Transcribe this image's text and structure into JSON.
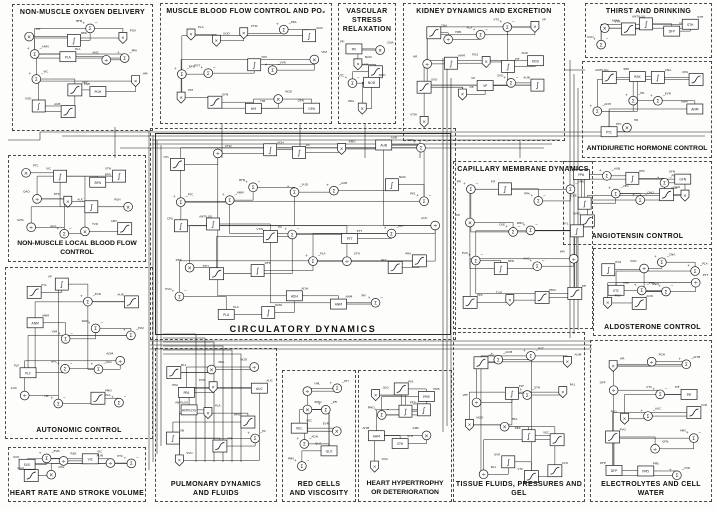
{
  "diagram": {
    "kind": "physiological-systems-block-diagram",
    "colors": {
      "ink": "#1c1c1c",
      "paper": "#fdfdfb",
      "section_border": "#4a4a4a"
    },
    "symbols": {
      "sum": "Σ",
      "multiply": "×",
      "divide": "÷",
      "plus": "+",
      "minus": "−",
      "integral": "∫"
    },
    "micro_labels": [
      "PO2",
      "STH",
      "POT",
      "POV",
      "AOM",
      "BFN",
      "PMO",
      "RMO",
      "EVR",
      "PVO",
      "OVA",
      "PK1",
      "PM5",
      "AUC",
      "AUB",
      "AUN",
      "PA1",
      "PLA",
      "PPA",
      "PRA",
      "QLO",
      "QAO",
      "VVR",
      "PTT",
      "HYL",
      "PTC",
      "PIF",
      "VTS",
      "AMC",
      "AMK",
      "CNA",
      "CKE",
      "ADH",
      "AHM",
      "VUD",
      "TVD",
      "GFN",
      "VTW",
      "HM",
      "VIM",
      "VP",
      "VB",
      "HPL",
      "HPR",
      "HR",
      "SVO",
      "PPC",
      "PFI",
      "DFP",
      "VPF",
      "PLF",
      "PGH",
      "CPG",
      "PC",
      "KOD",
      "NOD",
      "VEC",
      "VIC",
      "VTC",
      "ANM",
      "REK",
      "ANTILOG"
    ],
    "sections": [
      {
        "id": "non-muscle-oxygen-delivery",
        "title": "NON-MUSCLE  OXYGEN  DELIVERY",
        "box": [
          12,
          4,
          141,
          127
        ],
        "title_pos": "top",
        "n": 14
      },
      {
        "id": "muscle-blood-flow-control",
        "title": "MUSCLE BLOOD FLOW CONTROL AND PO₂",
        "box": [
          160,
          3,
          172,
          121
        ],
        "title_pos": "top",
        "n": 15
      },
      {
        "id": "vascular-stress-relaxation",
        "title": "VASCULAR\nSTRESS\nRELAXATION",
        "box": [
          338,
          3,
          58,
          121
        ],
        "title_pos": "top",
        "n": 7
      },
      {
        "id": "kidney-dynamics-and-excretion",
        "title": "KIDNEY  DYNAMICS  AND  EXCRETION",
        "box": [
          403,
          3,
          162,
          138
        ],
        "title_pos": "top",
        "n": 16
      },
      {
        "id": "thirst-and-drinking",
        "title": "THIRST  AND  DRINKING",
        "box": [
          585,
          3,
          127,
          55
        ],
        "title_pos": "top",
        "n": 6
      },
      {
        "id": "antidiuretic-hormone-control",
        "title": "ANTIDIURETIC  HORMONE  CONTROL",
        "box": [
          582,
          61,
          130,
          97
        ],
        "title_pos": "bottom",
        "n": 10,
        "tight": true
      },
      {
        "id": "angiotensin-control",
        "title": "ANGIOTENSIN  CONTROL",
        "box": [
          563,
          161,
          149,
          84
        ],
        "title_pos": "bottom",
        "n": 11
      },
      {
        "id": "aldosterone-control",
        "title": "ALDOSTERONE  CONTROL",
        "box": [
          593,
          248,
          119,
          88
        ],
        "title_pos": "bottom",
        "n": 10
      },
      {
        "id": "non-muscle-local-blood-flow",
        "title": "NON-MUSCLE  LOCAL  BLOOD  FLOW  CONTROL",
        "box": [
          8,
          155,
          138,
          107
        ],
        "title_pos": "bottom",
        "n": 12,
        "tight": true
      },
      {
        "id": "capillary-membrane-dynamics",
        "title": "CAPILLARY  MEMBRANE  DYNAMICS",
        "box": [
          453,
          161,
          140,
          168
        ],
        "title_pos": "top",
        "n": 16
      },
      {
        "id": "circulatory-dynamics",
        "title": "CIRCULATORY  DYNAMICS",
        "box": [
          150,
          128,
          306,
          212
        ],
        "title_pos": "bottom",
        "n": 34,
        "inner_frame": true,
        "big": true
      },
      {
        "id": "autonomic-control",
        "title": "AUTONOMIC  CONTROL",
        "box": [
          5,
          267,
          148,
          172
        ],
        "title_pos": "bottom",
        "n": 16
      },
      {
        "id": "heart-rate-and-stroke-volume",
        "title": "HEART RATE AND STROKE VOLUME",
        "box": [
          8,
          447,
          138,
          55
        ],
        "title_pos": "bottom",
        "n": 8
      },
      {
        "id": "pulmonary-dynamics-and-fluids",
        "title": "PULMONARY DYNAMICS\nAND FLUIDS",
        "box": [
          155,
          348,
          122,
          154
        ],
        "title_pos": "bottom",
        "n": 13
      },
      {
        "id": "red-cells-and-viscosity",
        "title": "RED CELLS\nAND VISCOSITY",
        "box": [
          282,
          370,
          74,
          132
        ],
        "title_pos": "bottom",
        "n": 9
      },
      {
        "id": "heart-hypertrophy-deterioration",
        "title": "HEART HYPERTROPHY\nOR DETERIORATION",
        "box": [
          358,
          370,
          94,
          132
        ],
        "title_pos": "bottom",
        "n": 10,
        "tight": true
      },
      {
        "id": "tissue-fluids-pressures-gel",
        "title": "TISSUE FLUIDS, PRESSURES AND GEL",
        "box": [
          453,
          332,
          132,
          170
        ],
        "title_pos": "bottom",
        "n": 16
      },
      {
        "id": "electrolytes-and-cell-water",
        "title": "ELECTROLYTES AND CELL WATER",
        "box": [
          590,
          340,
          122,
          162
        ],
        "title_pos": "bottom",
        "n": 15
      }
    ]
  }
}
